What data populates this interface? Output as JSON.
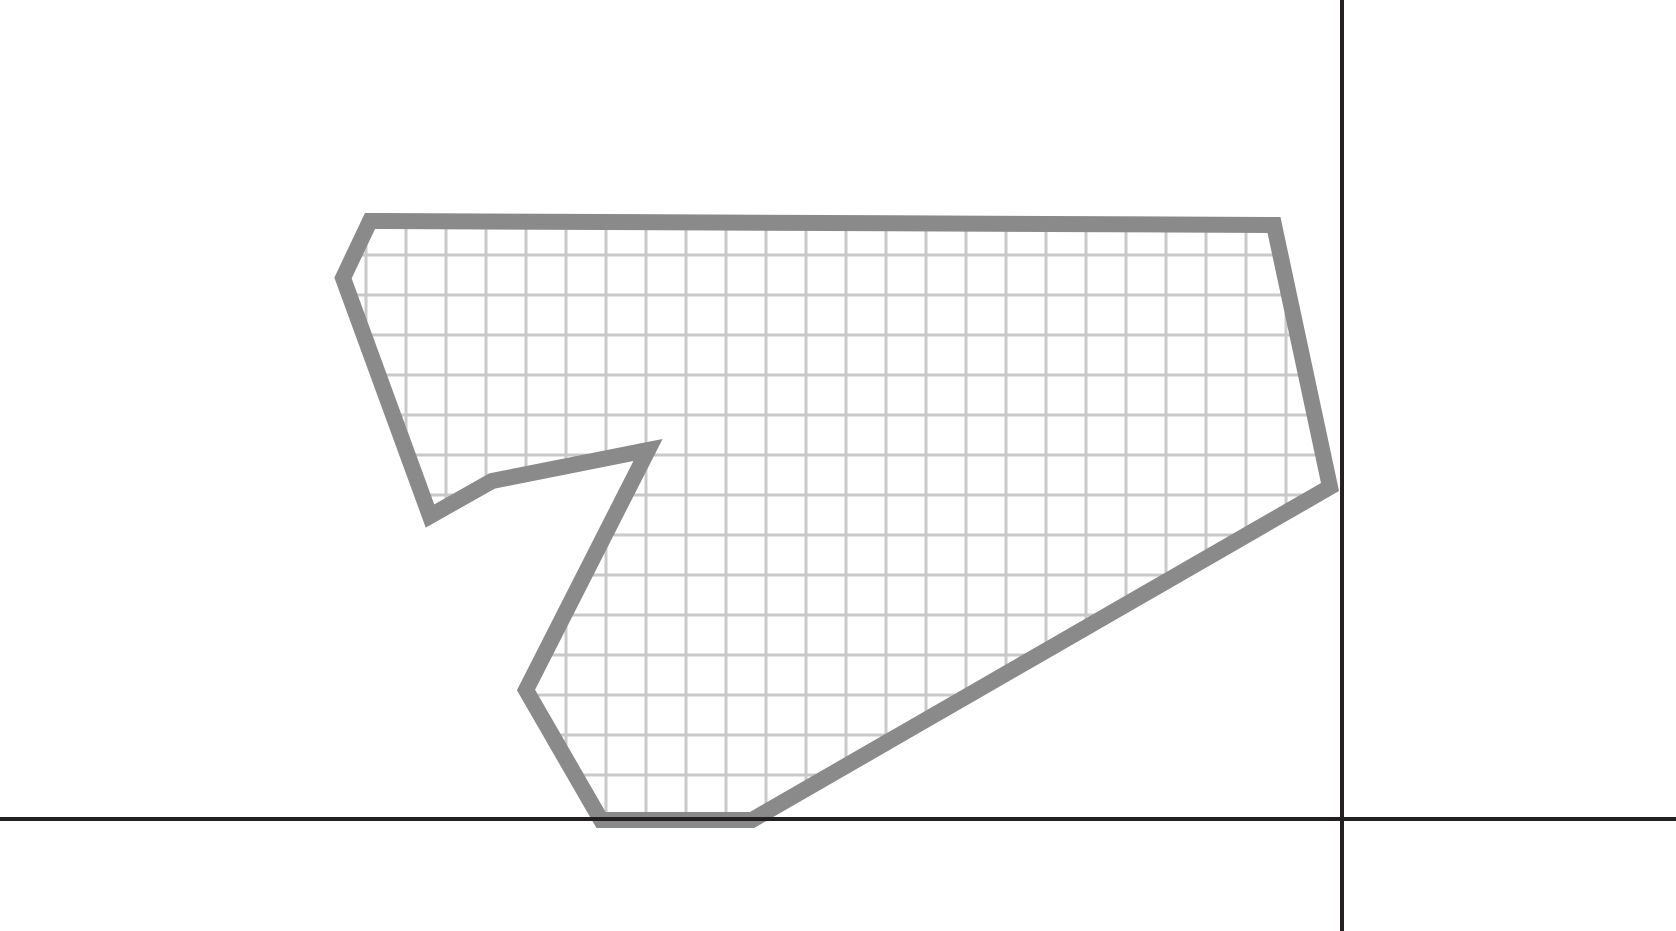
{
  "figure": {
    "kind": "geometry-diagram",
    "description": "Irregular ten-sided concave polygon outlined in thick gray and filled with a graph-paper grid, resting on the horizontal axis of an otherwise empty coordinate plane whose axes cross near the lower right",
    "canvas": {
      "width": 1676,
      "height": 931,
      "background": "#ffffff"
    },
    "axes": {
      "color": "#241f21",
      "thickness": 4,
      "x_axis": {
        "y": 819,
        "from_x": 0,
        "to_x": 1676
      },
      "y_axis": {
        "x": 1342,
        "from_y": 0,
        "to_y": 931
      }
    },
    "grid_fill": {
      "cell_size": 40,
      "line_width": 3,
      "line_color": "#c9c9c9",
      "offset_x": 6,
      "offset_y": 15,
      "background": "#ffffff"
    },
    "polygon": {
      "stroke_color": "#8a8a8a",
      "stroke_width": 16,
      "stroke_linejoin": "miter",
      "vertex_count": 10,
      "vertices": [
        {
          "x": 370,
          "y": 221
        },
        {
          "x": 343,
          "y": 278
        },
        {
          "x": 430,
          "y": 516
        },
        {
          "x": 492,
          "y": 481
        },
        {
          "x": 648,
          "y": 450
        },
        {
          "x": 526,
          "y": 690
        },
        {
          "x": 601,
          "y": 820
        },
        {
          "x": 752,
          "y": 820
        },
        {
          "x": 1330,
          "y": 487
        },
        {
          "x": 1274,
          "y": 225
        }
      ]
    }
  }
}
